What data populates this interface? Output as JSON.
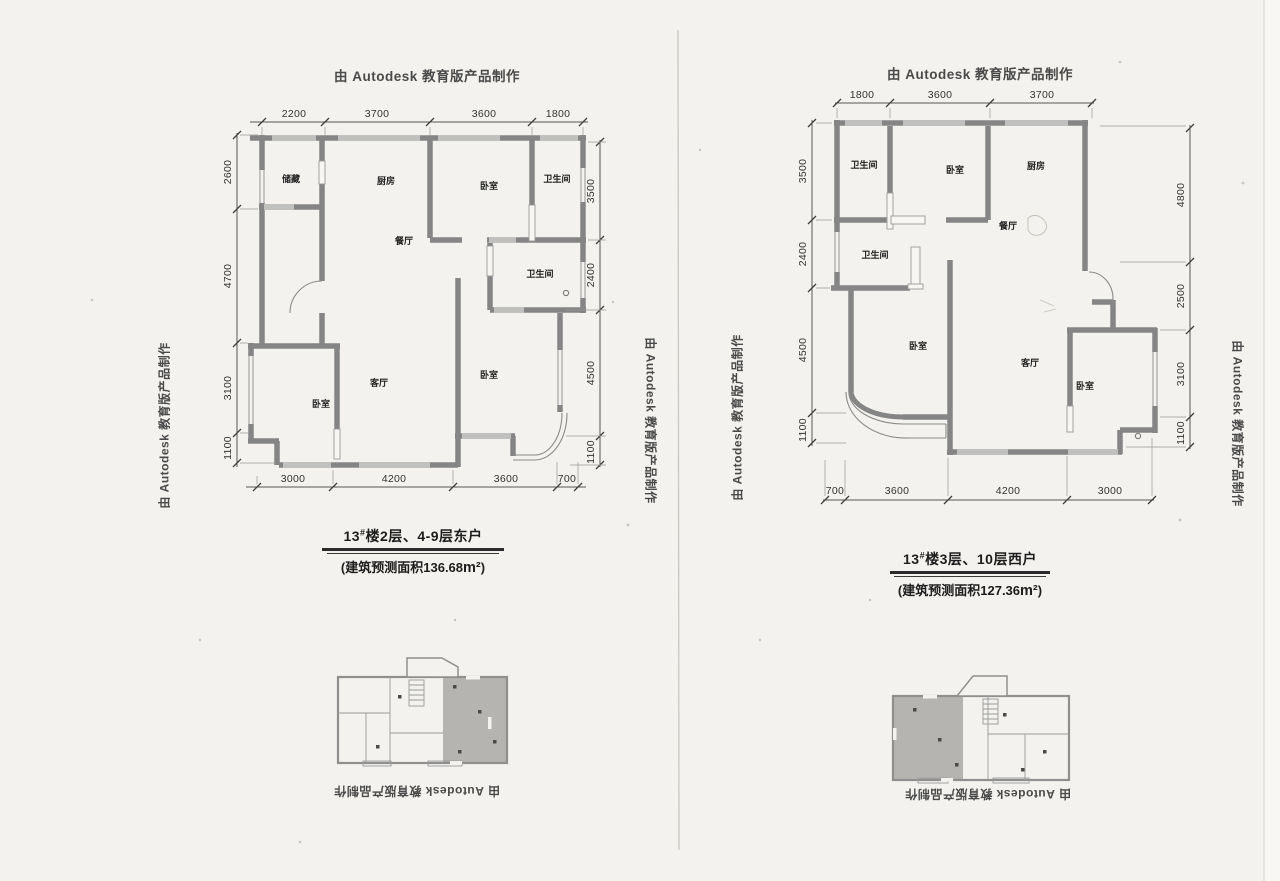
{
  "watermark": "由 Autodesk 教育版产品制作",
  "left_page": {
    "plan": {
      "dims_top": [
        "2200",
        "3700",
        "3600",
        "1800"
      ],
      "dims_left": [
        "2600",
        "4700",
        "3100",
        "1100"
      ],
      "dims_right": [
        "3500",
        "2400",
        "4500",
        "1100"
      ],
      "dims_bottom": [
        "3000",
        "4200",
        "3600",
        "700"
      ],
      "rooms": {
        "storage": "储藏",
        "kitchen": "厨房",
        "bedroom_top": "卧室",
        "bath_top": "卫生间",
        "dining": "餐厅",
        "bath_mid": "卫生间",
        "bedroom_mid": "卧室",
        "living": "客厅",
        "bedroom_bottom": "卧室"
      }
    },
    "title_num": "13",
    "title_sup": "#",
    "title_rest": "楼2层、4-9层东户",
    "area_open": "(",
    "area_label": "建筑预测面积",
    "area_value": "136.68",
    "area_unit": "m²",
    "area_close": ")"
  },
  "right_page": {
    "plan": {
      "dims_top": [
        "1800",
        "3600",
        "3700"
      ],
      "dims_left": [
        "3500",
        "2400",
        "4500",
        "1100"
      ],
      "dims_right": [
        "4800",
        "2500",
        "3100",
        "1100"
      ],
      "dims_bottom": [
        "700",
        "3600",
        "4200",
        "3000"
      ],
      "rooms": {
        "bath_top": "卫生间",
        "bedroom_top": "卧室",
        "kitchen": "厨房",
        "dining": "餐厅",
        "bath_mid": "卫生间",
        "bedroom_left": "卧室",
        "living": "客厅",
        "bedroom_right": "卧室"
      }
    },
    "title_num": "13",
    "title_sup": "#",
    "title_rest": "楼3层、10层西户",
    "area_open": "(",
    "area_label": "建筑预测面积",
    "area_value": "127.36",
    "area_unit": "m²",
    "area_close": ")"
  }
}
